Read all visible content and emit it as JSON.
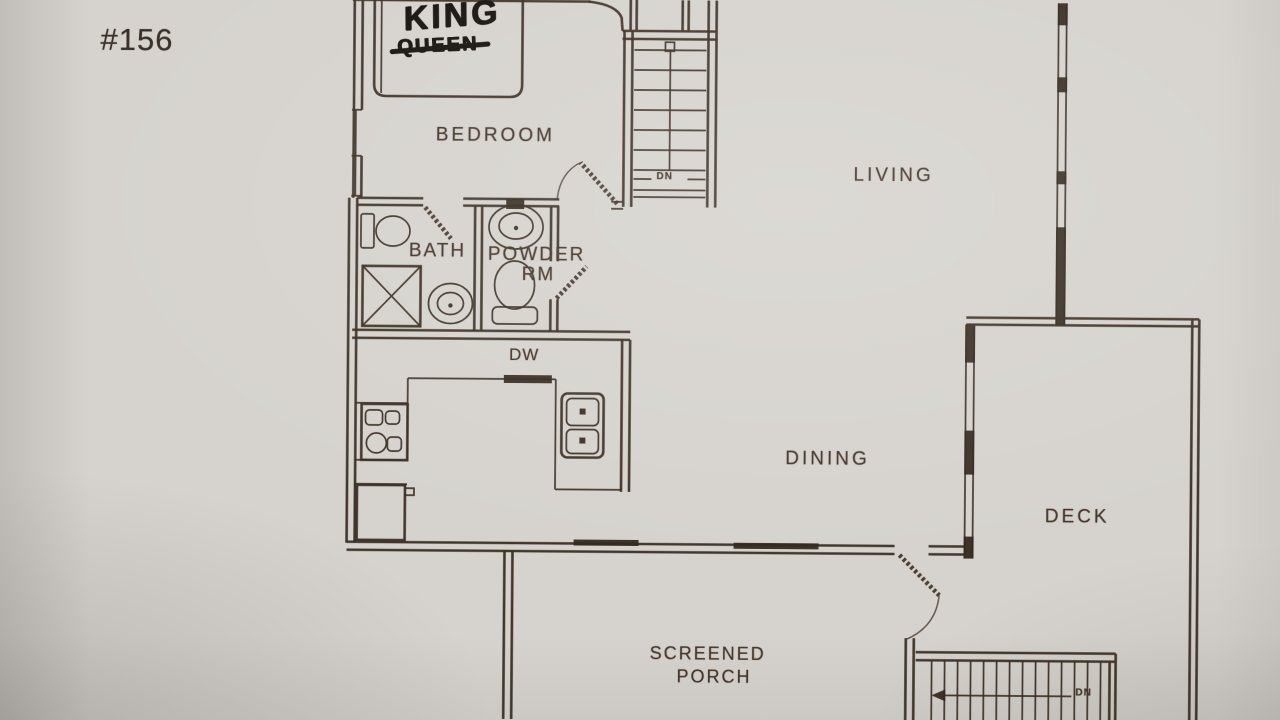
{
  "photo": {
    "paper_color": "#d6d3ce",
    "ink_color": "#3b2e24",
    "marker_color": "#16120e"
  },
  "unit": {
    "number": "#156"
  },
  "rooms": {
    "bedroom": "BEDROOM",
    "bath": "BATH",
    "powder_room_line1": "POWDER",
    "powder_room_line2": "RM",
    "living": "LIVING",
    "dining": "DINING",
    "deck": "DECK",
    "screened_porch_line1": "SCREENED",
    "screened_porch_line2": "PORCH"
  },
  "annotations": {
    "bed_size_new": "KING",
    "bed_size_old": "QUEEN",
    "dishwasher": "DW",
    "upper_stairs_direction": "DN",
    "deck_stairs_direction": "DN"
  }
}
